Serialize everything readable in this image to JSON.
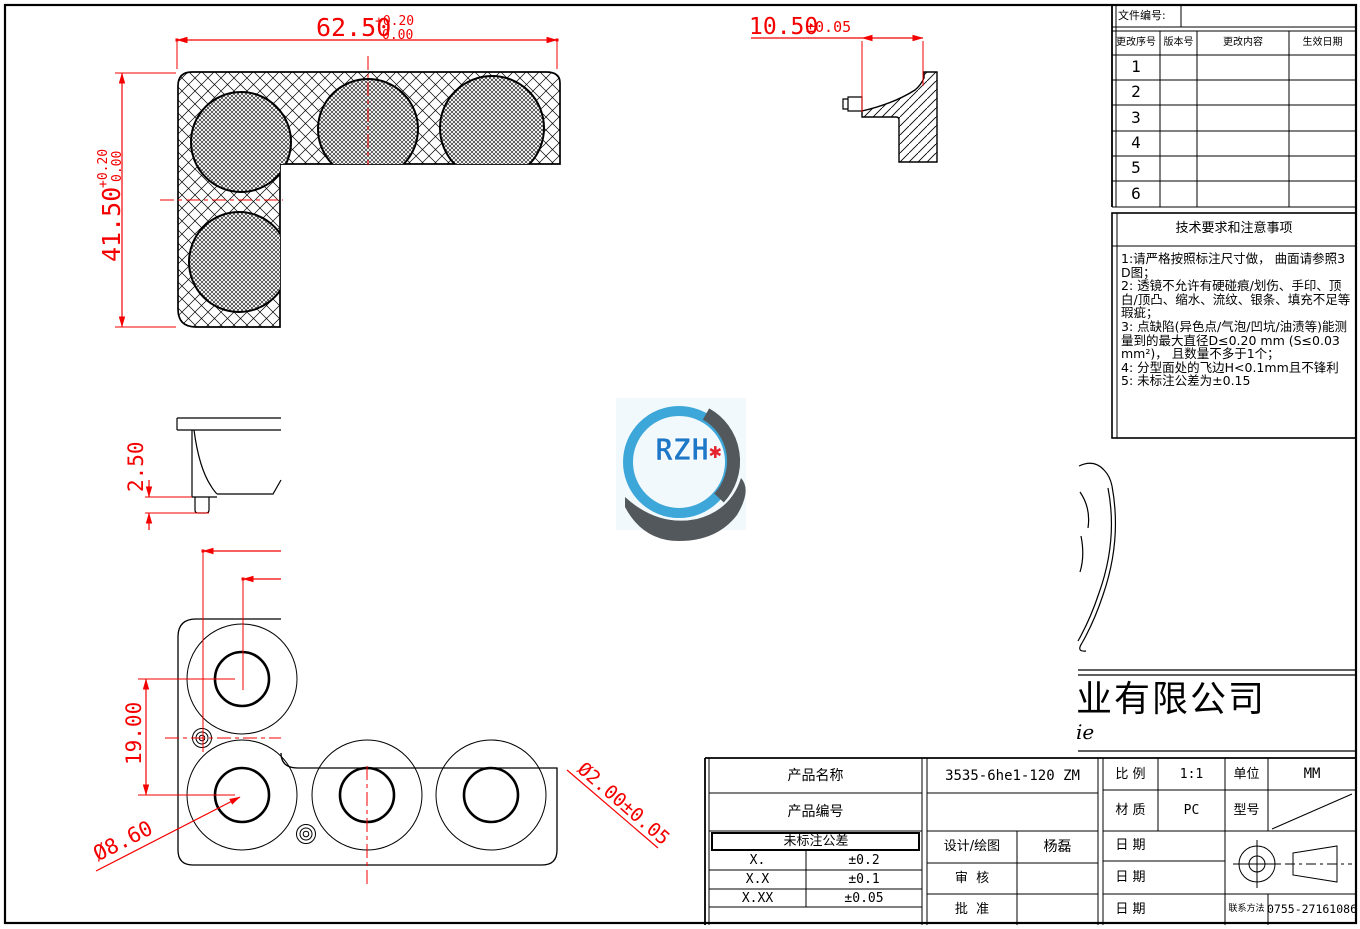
{
  "colors": {
    "dimension_red": "#f40000",
    "line_black": "#000000",
    "logo_ring_blue": "#2f9fd6",
    "logo_text_blue": "#1e78c8",
    "logo_dark_gray": "#53585d",
    "logo_star_red": "#e4232f"
  },
  "dims": {
    "section_width": "62.50",
    "section_width_tol_up": "+0.20",
    "section_width_tol_low": "0.00",
    "section_height": "41.50",
    "section_height_tol_up": "+0.20",
    "section_height_tol_low": "0.00",
    "detail_width": "10.50",
    "detail_width_tol": "±0.05",
    "foot_height": "2.50",
    "lens_pitch": "19.00",
    "lens_diameter": "Ø8.60",
    "pin_diameter": "Ø2.00±0.05"
  },
  "logo": {
    "text": "RZH",
    "star": "✱"
  },
  "company": {
    "name_partial": "业有限公司",
    "latin_partial": "ie"
  },
  "revision_table": {
    "file_no_label": "文件编号:",
    "headers": [
      "更改序号",
      "版本号",
      "更改内容",
      "生效日期"
    ],
    "rows": [
      "1",
      "2",
      "3",
      "4",
      "5",
      "6"
    ]
  },
  "tech_notes": {
    "title": "技术要求和注意事项",
    "notes": [
      "1:请严格按照标注尺寸做， 曲面请参照3D图；",
      "2: 透镜不允许有硬碰痕/划伤、手印、顶白/顶凸、缩水、流纹、银条、填充不足等瑕疵；",
      "3: 点缺陷(异色点/气泡/凹坑/油渍等)能测量到的最大直径D≤0.20 mm (S≤0.03 mm²)， 且数量不多于1个；",
      "4: 分型面处的飞边H<0.1mm且不锋利",
      "5: 未标注公差为±0.15"
    ]
  },
  "title_block": {
    "product_name_label": "产品名称",
    "product_name": "3535-6he1-120 ZM",
    "product_no_label": "产品编号",
    "tolerance_title": "未标注公差",
    "tolerances": [
      {
        "digits": "X.",
        "value": "±0.2"
      },
      {
        "digits": "X.X",
        "value": "±0.1"
      },
      {
        "digits": "X.XX",
        "value": "±0.05"
      }
    ],
    "designer_label": "设计/绘图",
    "designer": "杨磊",
    "reviewer_label": "审  核",
    "approver_label": "批  准",
    "scale_label": "比 例",
    "scale": "1:1",
    "unit_label": "单位",
    "unit": "MM",
    "material_label": "材 质",
    "material": "PC",
    "model_label": "型号",
    "date_label": "日 期",
    "contact_label": "联系方法",
    "contact": "0755-27161086"
  }
}
